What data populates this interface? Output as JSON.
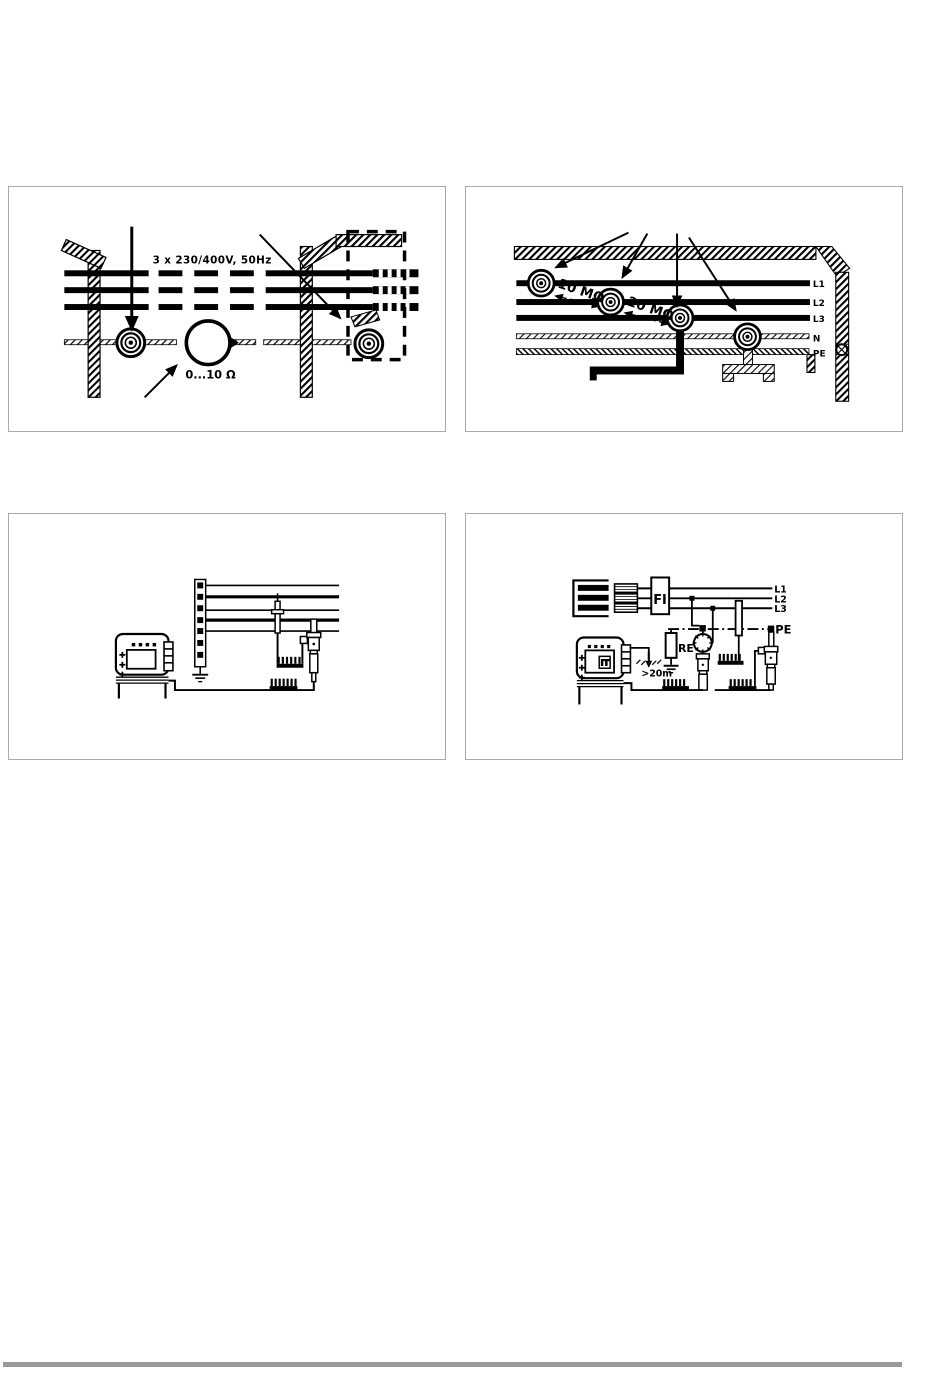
{
  "page": {
    "bg_color": "#ffffff",
    "footer_rule_color": "#999999",
    "panel_border_color": "#aaaaaa",
    "diagram_color": "#000000"
  },
  "panel_overhead_line": {
    "name": "overhead-supply-line-loop-resistance-diagram",
    "voltage_label": "3 x 230/400V, 50Hz",
    "loop_resistance_label": "0...10 Ω"
  },
  "panel_insulation": {
    "name": "insulation-resistance-diagram",
    "resistance_1": "10 MΩ",
    "resistance_2": "20 MΩ",
    "line_labels": [
      "L1",
      "L2",
      "L3",
      "N",
      "PE"
    ]
  },
  "panel_continuity": {
    "name": "continuity-measurement-diagram"
  },
  "panel_earth": {
    "name": "earth-resistance-measurement-diagram",
    "rcd_label": "FI",
    "earth_resistor_label": "RE",
    "distance_label": ">20m",
    "display_label": "IT",
    "line_labels": [
      "L1",
      "L2",
      "L3"
    ],
    "pe_label": "PE"
  }
}
